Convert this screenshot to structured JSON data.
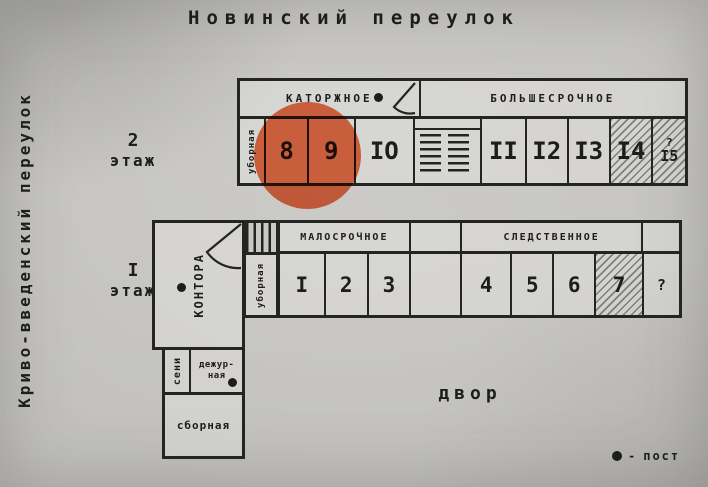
{
  "page": {
    "street_top": "Новинский переулок",
    "street_left": "Криво-введенский переулок",
    "courtyard": "двор"
  },
  "legend": {
    "symbol": "●",
    "separator": "-",
    "label": "пост"
  },
  "floor2": {
    "floor_number": "2",
    "floor_word": "этаж",
    "section_left": "КАТОРЖНОЕ",
    "section_right": "БОЛЬШЕСРОЧНОЕ",
    "utility_room": "уборная",
    "rooms": [
      {
        "label": "8",
        "highlighted": true
      },
      {
        "label": "9"
      },
      {
        "label": "IO"
      },
      {
        "label": "II"
      },
      {
        "label": "I2"
      },
      {
        "label": "I3"
      },
      {
        "label": "I4",
        "hatched": true
      },
      {
        "label": "I5",
        "prefix": "?",
        "hatched": true
      }
    ]
  },
  "floor1": {
    "floor_number": "I",
    "floor_word": "этаж",
    "section_left": "МАЛОСРОЧНОЕ",
    "section_right": "СЛЕДСТВЕННОЕ",
    "office": "КОНТОРА",
    "utility_room": "уборная",
    "entry_room": "сени",
    "duty_room": [
      "дежур-",
      "ная"
    ],
    "assembly_room": "сборная",
    "rooms": [
      {
        "label": "I"
      },
      {
        "label": "2"
      },
      {
        "label": "3"
      },
      {
        "label": "4"
      },
      {
        "label": "5"
      },
      {
        "label": "6"
      },
      {
        "label": "7",
        "hatched": true
      },
      {
        "label": "?",
        "unknown": true
      }
    ]
  },
  "highlight": {
    "target_room": "8",
    "color": "#d0512e"
  }
}
